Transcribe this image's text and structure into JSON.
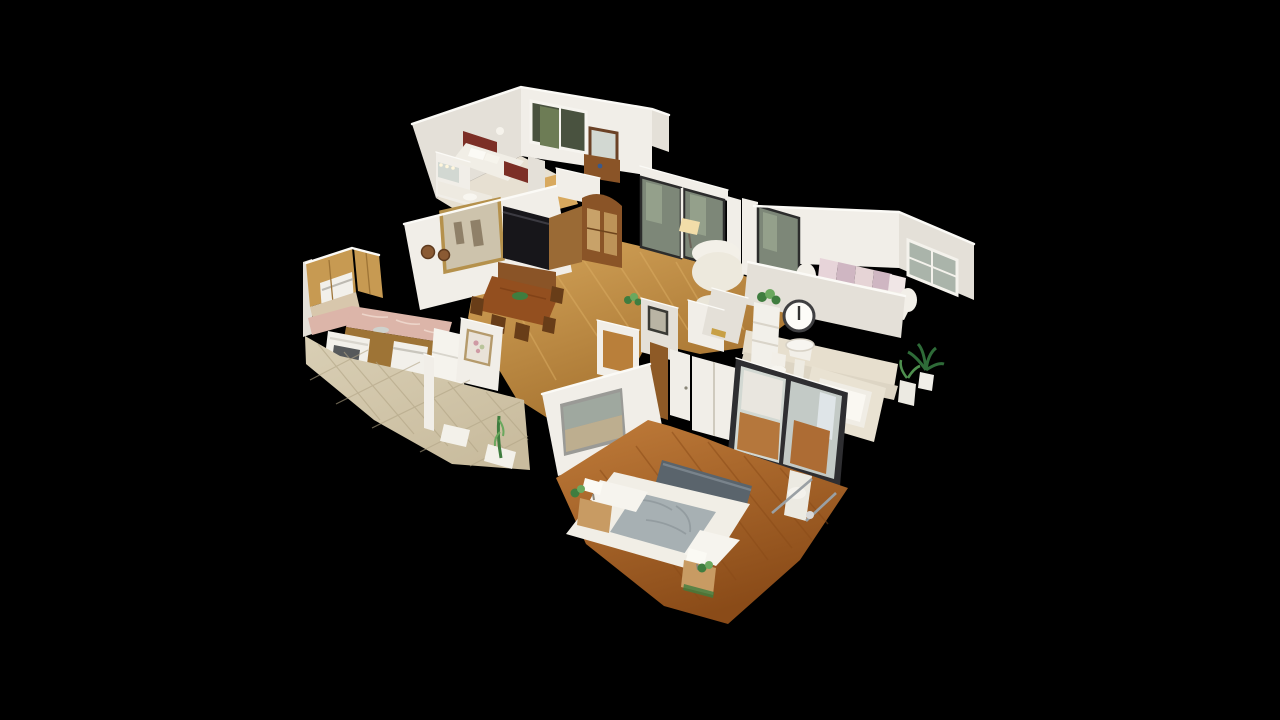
{
  "meta": {
    "description": "3D dollhouse cutaway view of a single-story home interior, seen from above at an angle, floating on a solid black background (3D tour dollhouse mode).",
    "view_mode": "dollhouse",
    "background_color": "#000000"
  },
  "palette": {
    "bg": "#000000",
    "cut": "#fbfaf6",
    "wallA": "#f1eee8",
    "wallB": "#e4e0d8",
    "wallC": "#d3cec4",
    "woodFloor": "#c08a42",
    "woodFloorLight": "#d8a95e",
    "woodFloorDark": "#a06c2a",
    "bedFloor": "#ad6a2b",
    "bedFloorLight": "#c07c3a",
    "bedFloorDark": "#8a4b18",
    "tile": "#c9bc9e",
    "tileLight": "#d9cfb5",
    "tileDark": "#b0a384",
    "oak": "#c79a52",
    "oakDark": "#9e7436",
    "counter": "#dcb5a9",
    "counterLight": "#edd6cb",
    "appliance": "#f2f0ea",
    "maroon": "#7c2f26",
    "linen": "#f1eee6",
    "grayBlanket": "#a7b0b3",
    "slate": "#5a646c",
    "woodFurn": "#8a5427",
    "woodFurnDark": "#683d18",
    "black": "#17161a",
    "glass": "#7d8778",
    "glassLight": "#9aa690",
    "mirror": "#d2d8d2",
    "mirrorDark": "#c3cac6",
    "gold": "#b5914c",
    "green": "#3f7d3f",
    "greenDark": "#2e6b38",
    "greenLight": "#6aa85e",
    "pink1": "#e7d4d9",
    "pink2": "#cfb6c2",
    "frameDark": "#2e2e31",
    "tub": "#f0ede5",
    "wainscot": "#e7dfce",
    "lampWarm": "#f2dda9",
    "paintCanvas": "#cdc3ac",
    "artSky": "#9fa89f",
    "artSand": "#bdae8f",
    "windowTree": "#49523f",
    "windowTreeLight": "#6d7c55"
  },
  "rooms": [
    {
      "id": "guest-bedroom",
      "label": "Guest Bedroom",
      "objects": [
        "bed with maroon headboard and footboard",
        "white bedding",
        "picture window with garden view",
        "framed wall mirror",
        "wood console dresser",
        "vanity with sink and mirror lights"
      ]
    },
    {
      "id": "living-room",
      "label": "Living Room",
      "objects": [
        "gold framed painting",
        "two decorative wall plates",
        "black upright piano with bench",
        "wood china cabinet",
        "sliding glass patio doors",
        "white wingback armchair",
        "lit floor lamp"
      ]
    },
    {
      "id": "dining-area",
      "label": "Dining Area",
      "objects": [
        "carved wood dining table",
        "wood chairs",
        "green centerpiece"
      ]
    },
    {
      "id": "kitchen",
      "label": "Kitchen",
      "objects": [
        "honey oak cabinets",
        "white microwave",
        "white range",
        "white dishwasher",
        "white refrigerator",
        "rose marble countertop",
        "beige tile floor",
        "floral painting",
        "floor mats",
        "tall green plant"
      ]
    },
    {
      "id": "second-bedroom",
      "label": "Second Bedroom",
      "objects": [
        "daybed with pink and white pillows",
        "window",
        "sliding glass door"
      ]
    },
    {
      "id": "bathroom",
      "label": "Bathroom",
      "objects": [
        "round wall clock",
        "white etagere shelf with plant",
        "pedestal sink",
        "toilet",
        "bathtub with tile deck",
        "potted plants"
      ]
    },
    {
      "id": "master-bedroom",
      "label": "Master Bedroom",
      "objects": [
        "bed with slate headboard and rumpled gray-white bedding",
        "two nightstands with white lamps and plants",
        "panoramic landscape artwork",
        "mirrored sliding closet doors",
        "white closet doors",
        "exercise machine",
        "orange hardwood floor"
      ]
    }
  ]
}
